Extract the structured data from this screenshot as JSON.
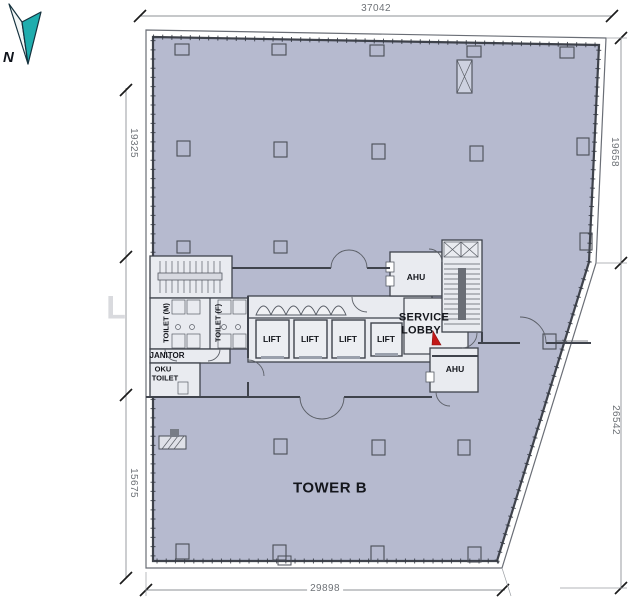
{
  "plan": {
    "name": "TOWER B",
    "north_label": "N",
    "watermark_letter": "L",
    "dimensions": {
      "top": "37042",
      "left_upper": "19325",
      "left_lower": "15675",
      "right_upper": "19658",
      "right_lower": "26542",
      "bottom": "29898"
    },
    "labels": {
      "toilet_male": "TOILET (M)",
      "toilet_female": "TOILET (F)",
      "janitor": "JANITOR",
      "oku_line1": "OKU",
      "oku_line2": "TOILET",
      "service_lobby_line1": "SERVICE",
      "service_lobby_line2": "LOBBY",
      "ahu_upper": "AHU",
      "ahu_lower": "AHU",
      "lift_1": "LIFT",
      "lift_2": "LIFT",
      "lift_3": "LIFT",
      "lift_4": "LIFT",
      "tower": "TOWER B"
    },
    "colors": {
      "floor": "#b6bacf",
      "core": "#e9ebf0",
      "wall": "#3f434c",
      "dimension_text": "#6e7277",
      "dimension_line": "#8d9196",
      "north_teal": "#1fadae",
      "fire_door_red": "#c31818",
      "watermark": "#d9dade"
    }
  }
}
